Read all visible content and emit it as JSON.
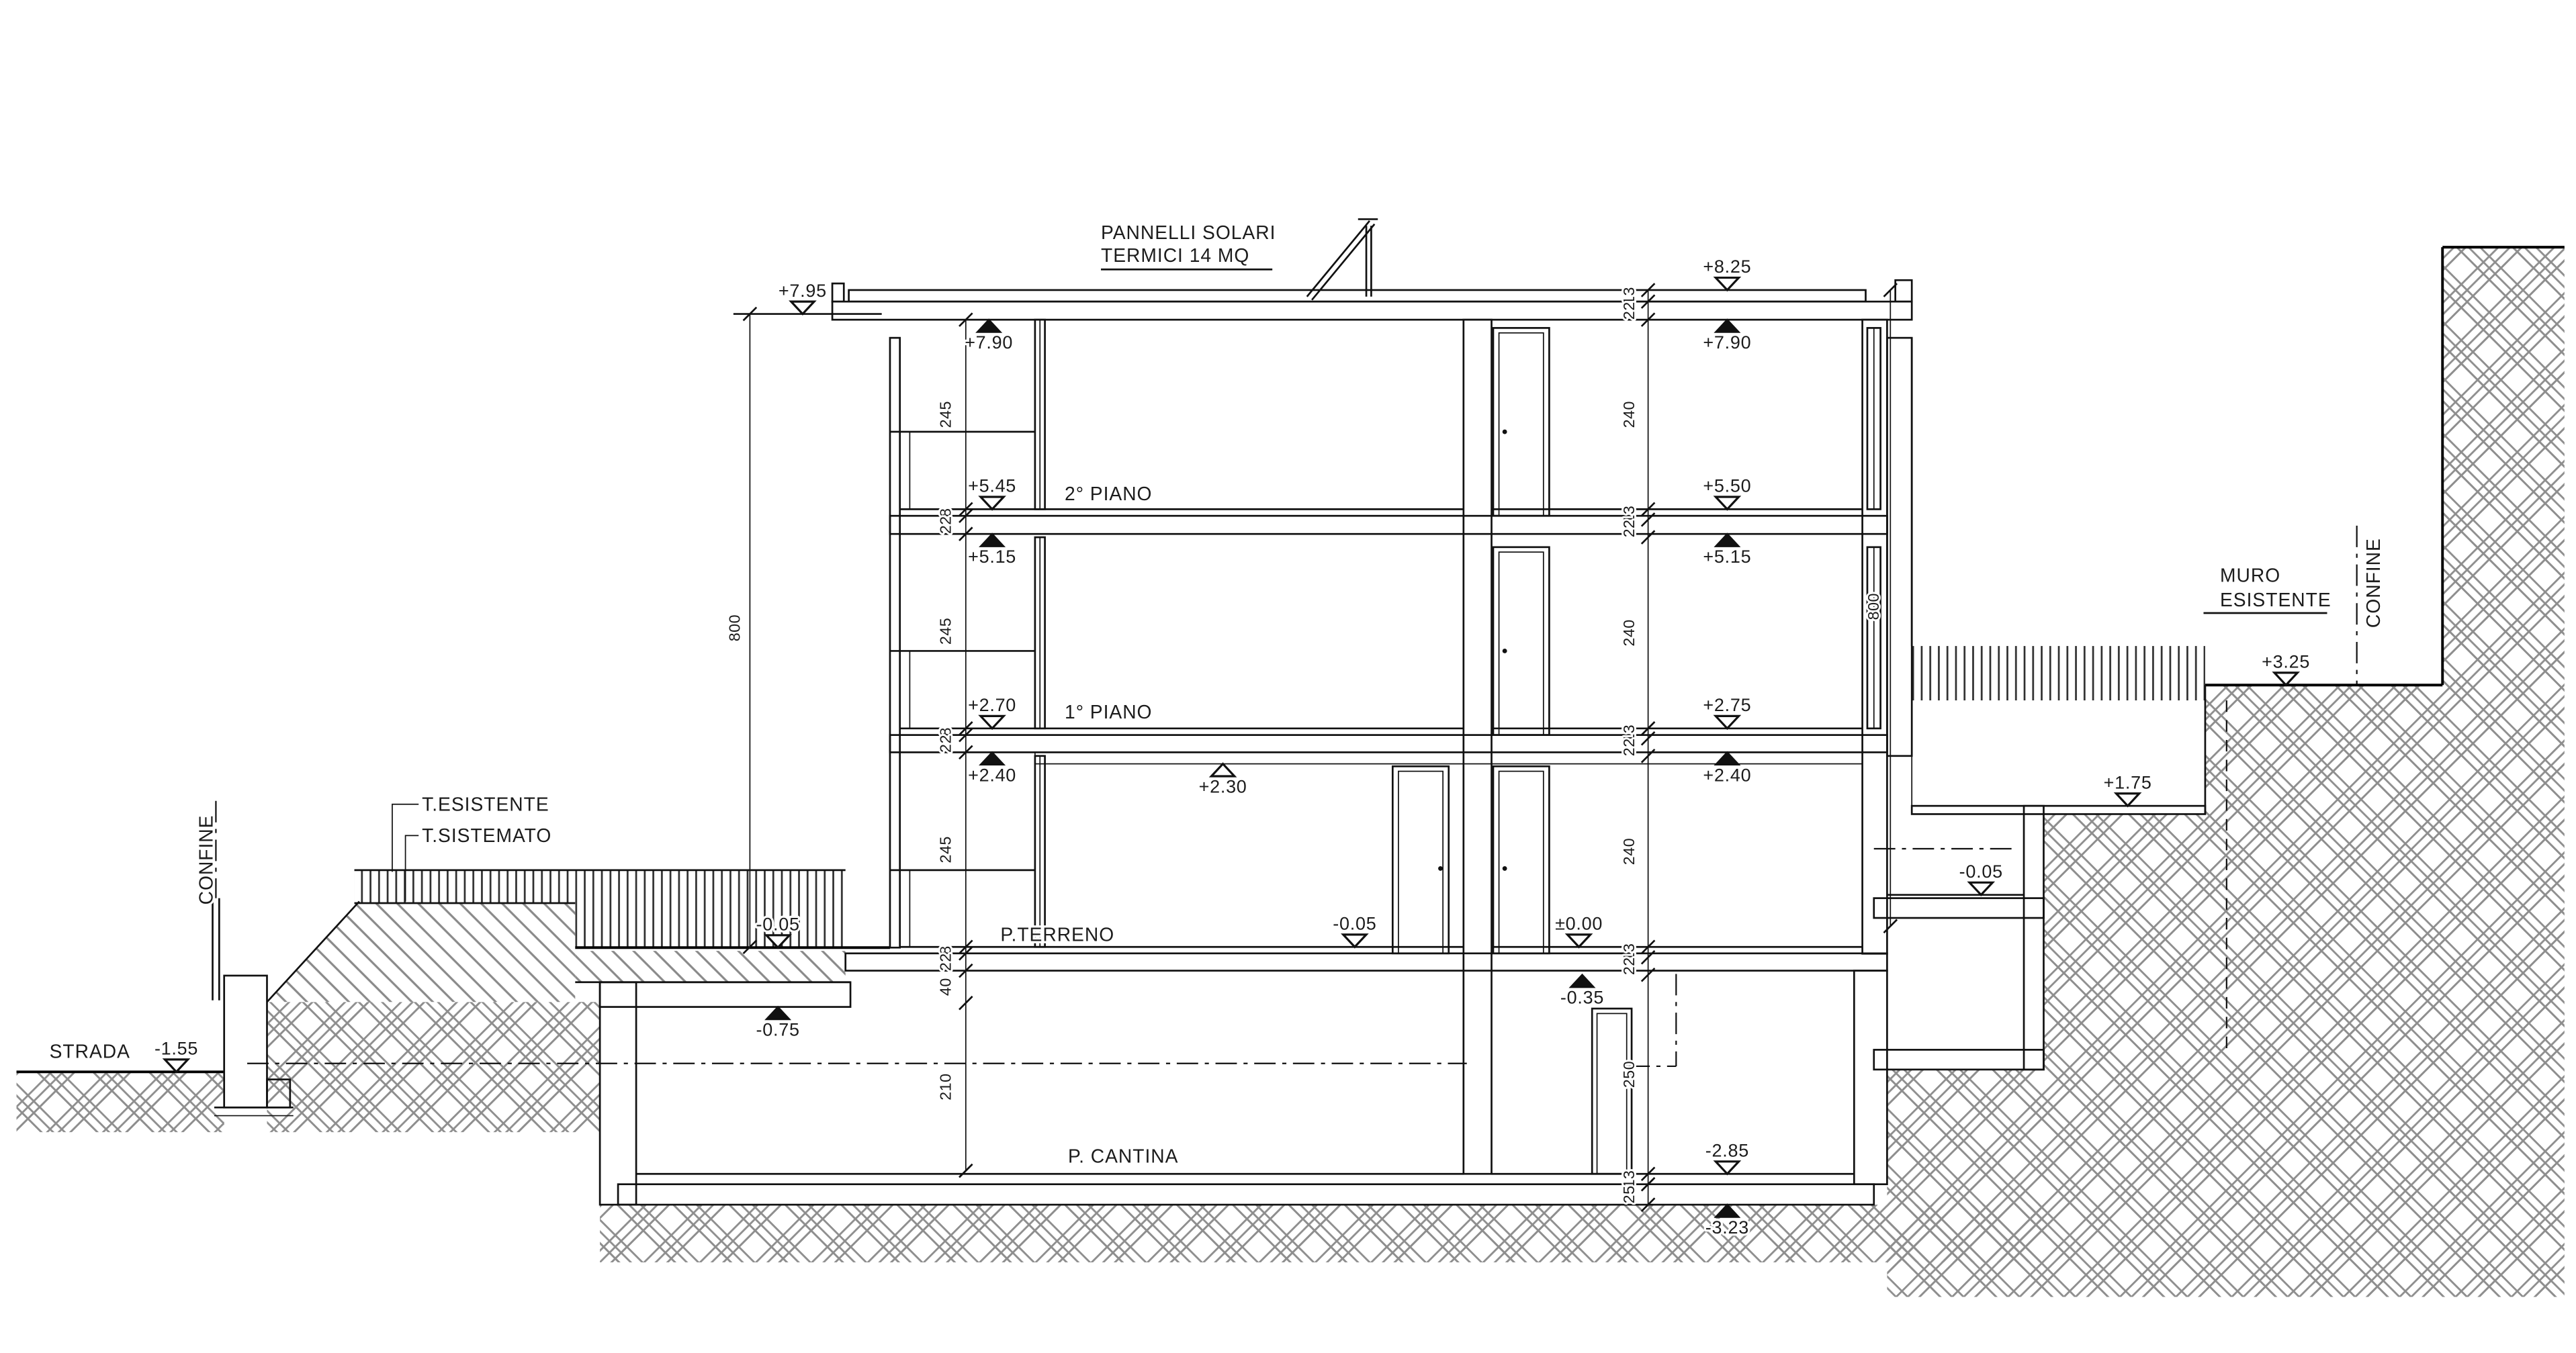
{
  "drawing": {
    "note_solar": {
      "line1": "PANNELLI SOLARI",
      "line2": "TERMICI 14 MQ"
    },
    "floors": {
      "piano2": "2° PIANO",
      "piano1": "1° PIANO",
      "terreno": "P.TERRENO",
      "cantina": "P. CANTINA"
    },
    "site": {
      "strada": "STRADA",
      "confine_left": "CONFINE",
      "confine_right": "CONFINE",
      "muro_line1": "MURO",
      "muro_line2": "ESISTENTE",
      "terreno_esistente": "T.ESISTENTE",
      "terreno_sistemato": "T.SISTEMATO"
    },
    "levels": {
      "lv_795": "+7.95",
      "lv_825": "+8.25",
      "lv_790L": "+7.90",
      "lv_790R": "+7.90",
      "lv_550": "+5.50",
      "lv_545": "+5.45",
      "lv_515L": "+5.15",
      "lv_515R": "+5.15",
      "lv_275": "+2.75",
      "lv_270": "+2.70",
      "lv_240L": "+2.40",
      "lv_240R": "+2.40",
      "lv_230": "+2.30",
      "lv_005T": "-0.05",
      "lv_005M": "-0.05",
      "lv_000": "±0.00",
      "lv_035": "-0.35",
      "lv_075": "-0.75",
      "lv_285": "-2.85",
      "lv_323": "-3.23",
      "lv_155": "-1.55",
      "lv_325": "+3.25",
      "lv_175": "+1.75",
      "lv_005R": "-0.05"
    },
    "dims": {
      "left": [
        "245",
        "8",
        "22",
        "245",
        "8",
        "22",
        "245",
        "8",
        "22",
        "40",
        "210"
      ],
      "right": [
        "13",
        "22",
        "240",
        "13",
        "22",
        "240",
        "13",
        "22",
        "240",
        "13",
        "22",
        "250",
        "13",
        "25"
      ],
      "outer": [
        "800",
        "800"
      ]
    }
  }
}
